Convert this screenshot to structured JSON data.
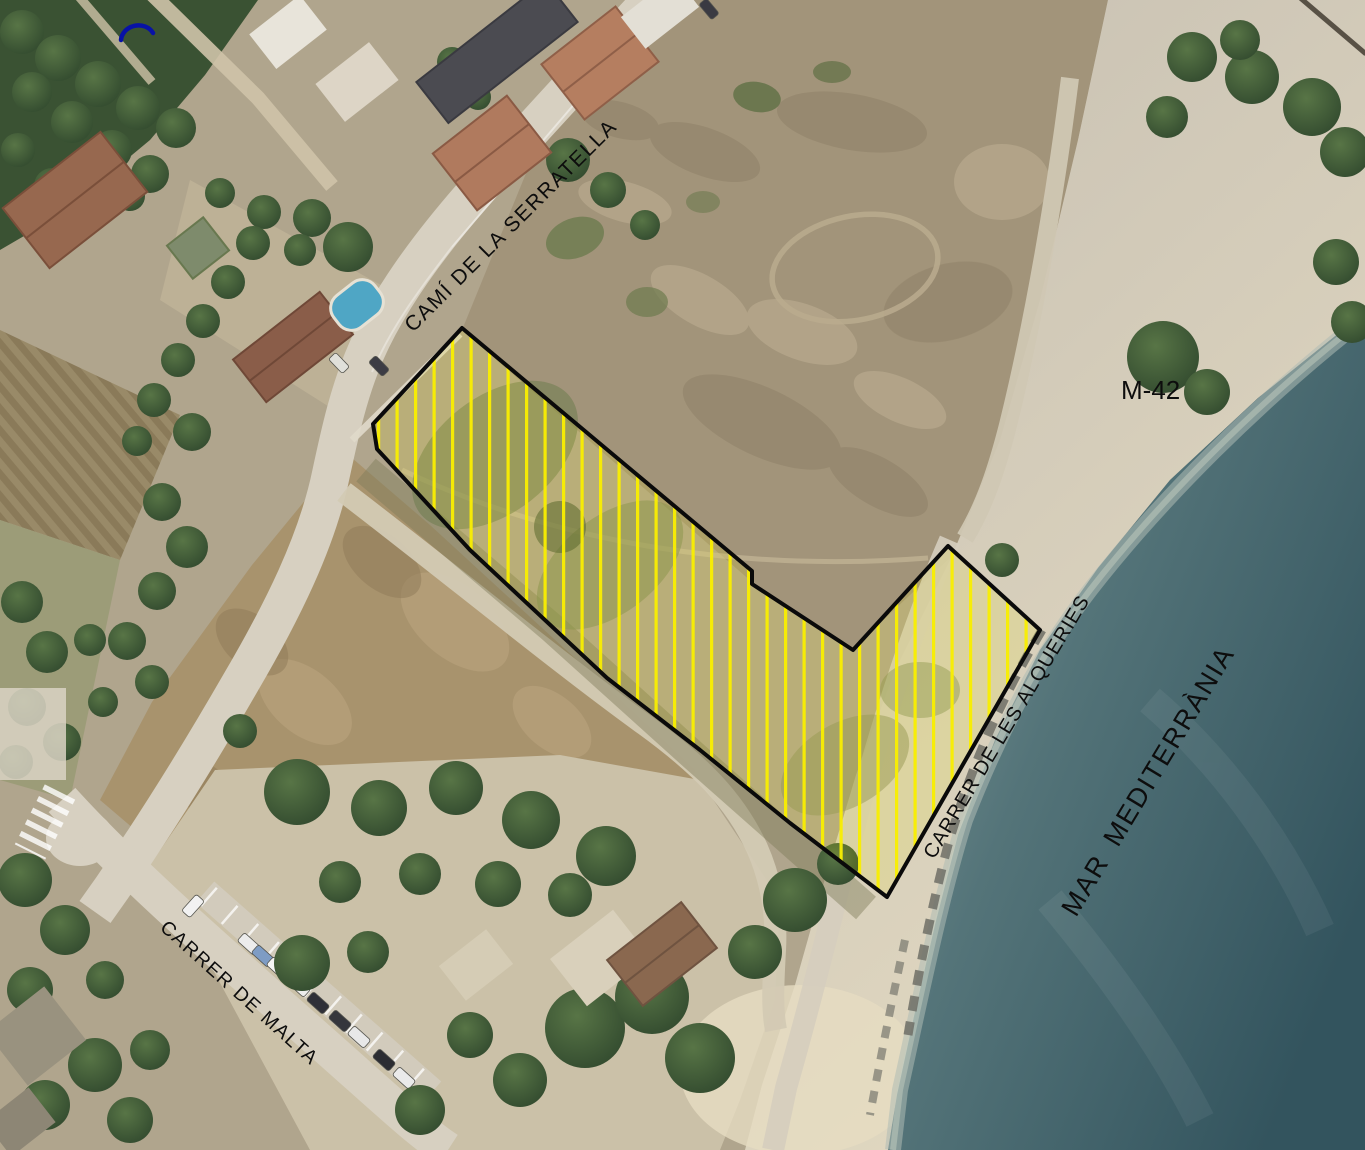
{
  "map": {
    "labels": {
      "road_top": "CAMÍ DE LA SERRATELLA",
      "road_number": "M-42",
      "road_coast": "CARRER DE LES ALQUERIES",
      "sea": "MAR  MEDITERRÀNIA",
      "road_bottom": "CARRER DE MALTA"
    },
    "parcel": {
      "points": "462,328 752,571 752,584 853,650 948,546 1040,630 887,897 790,823 700,750 607,678 470,550 377,449 373,424",
      "hatch_color": "#f8ee00",
      "tint_color": "#f5ea00",
      "outline_color": "#0a0a0a"
    },
    "annotation": {
      "color": "#0812a6"
    },
    "colors": {
      "label": "#0d0d0d",
      "land": "#b0a58d",
      "field": "#a2947a",
      "road": "#d7d0c1",
      "beach": "#c6bfb2",
      "beach_light": "#e2d9c1",
      "sea_shallow": "#87a0a1",
      "sea_deep": "#33545e",
      "tree_light": "#587546",
      "tree_dark": "#31492e"
    }
  }
}
